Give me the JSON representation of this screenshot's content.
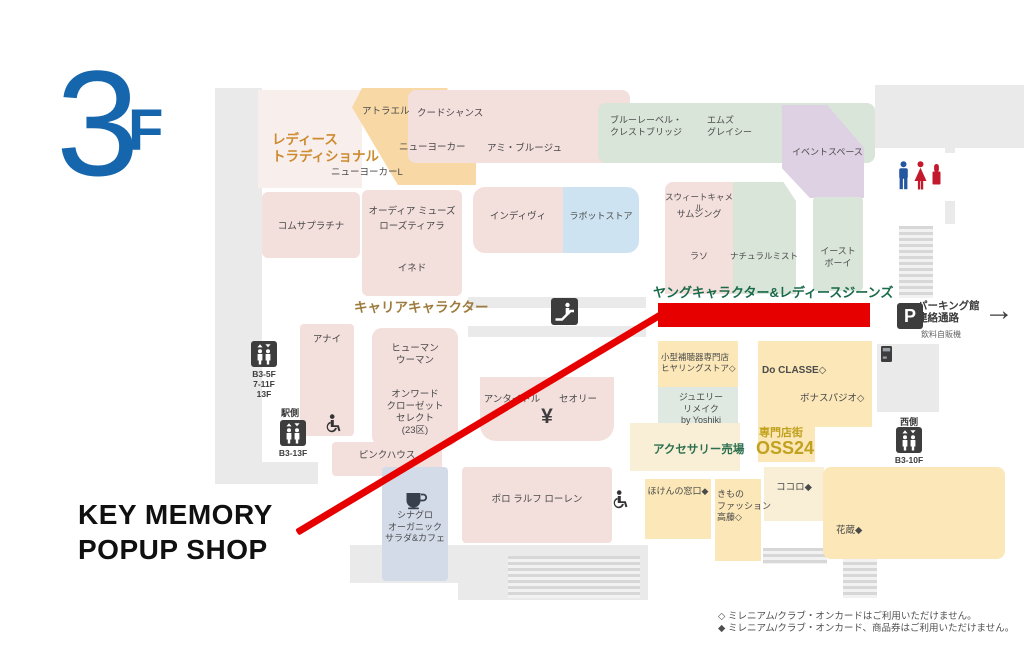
{
  "floor_label": {
    "number": "3",
    "suffix": "F"
  },
  "popup_annotation": {
    "line1": "KEY MEMORY",
    "line2": "POPUP SHOP"
  },
  "highlight": {
    "color": "#e60000",
    "target_label": "ヤングキャラクター&レディースジーンズ"
  },
  "notes": {
    "line1": "◇ ミレニアム/クラブ・オンカードはご利用いただけません。",
    "line2": "◆ ミレニアム/クラブ・オンカード、商品券はご利用いただけません。"
  },
  "colors": {
    "pink": "#f3dfdc",
    "palepink": "#f8efec",
    "orange": "#f8d9a6",
    "green": "#d9e5d9",
    "purple": "#ddd1e3",
    "blue": "#cde3f1",
    "bluegray": "#d3dbe9",
    "yellow": "#fbe7b7",
    "cream": "#f9efd7",
    "jewelry": "#dfe9e1",
    "white": "#ffffff",
    "accentBlue": "#1566ad",
    "red": "#e60000",
    "grayStruct": "#eaeaea"
  },
  "map": {
    "structures": [
      {
        "id": "left-corridor",
        "x": 215,
        "y": 88,
        "w": 47,
        "h": 376
      },
      {
        "id": "left-bottom-band",
        "x": 215,
        "y": 462,
        "w": 103,
        "h": 22
      },
      {
        "id": "top-right-corridor",
        "x": 875,
        "y": 85,
        "w": 149,
        "h": 63
      },
      {
        "id": "right-thin-strip",
        "x": 945,
        "y": 148,
        "w": 10,
        "h": 76
      },
      {
        "id": "right-mid-block",
        "x": 877,
        "y": 344,
        "w": 62,
        "h": 68
      },
      {
        "id": "center-corridor-bar-1",
        "x": 468,
        "y": 297,
        "w": 178,
        "h": 11
      },
      {
        "id": "center-corridor-bar-2",
        "x": 468,
        "y": 326,
        "w": 178,
        "h": 11
      },
      {
        "id": "bottom-corridor",
        "x": 458,
        "y": 545,
        "w": 190,
        "h": 55
      },
      {
        "id": "bottom-left-band",
        "x": 350,
        "y": 545,
        "w": 108,
        "h": 38
      }
    ],
    "stairs": [
      {
        "id": "parking-stairs",
        "x": 899,
        "y": 226,
        "w": 34,
        "h": 72
      },
      {
        "id": "bottom-center-stairs",
        "x": 508,
        "y": 556,
        "w": 132,
        "h": 42
      },
      {
        "id": "bottom-right-stairs",
        "x": 843,
        "y": 550,
        "w": 34,
        "h": 48
      },
      {
        "id": "small-stairs",
        "x": 763,
        "y": 548,
        "w": 64,
        "h": 16
      }
    ],
    "regions": [
      {
        "id": "ladies-traditional-area",
        "x": 258,
        "y": 90,
        "w": 104,
        "h": 98,
        "c": "palepink"
      },
      {
        "id": "atrael-new-yorker-block",
        "x": 352,
        "y": 88,
        "w": 124,
        "h": 97,
        "c": "orange",
        "clip": "polygon(8% 0%, 77% 0%, 77% 26%, 100% 50%, 100% 100%, 37% 100%, 0% 20%)"
      },
      {
        "id": "womens-top-block",
        "x": 408,
        "y": 90,
        "w": 222,
        "h": 73,
        "c": "pink",
        "r": 8
      },
      {
        "id": "green-top-block",
        "x": 598,
        "y": 103,
        "w": 277,
        "h": 60,
        "c": "green",
        "r": 8
      },
      {
        "id": "event-space-block",
        "x": 782,
        "y": 105,
        "w": 82,
        "h": 93,
        "c": "purple",
        "clip": "polygon(0% 0%, 55% 0%, 100% 46%, 100% 100%, 34% 100%, 0% 68%)"
      },
      {
        "id": "restroom-block",
        "x": 880,
        "y": 153,
        "w": 78,
        "h": 48,
        "c": "white"
      },
      {
        "id": "comme-ca-block",
        "x": 262,
        "y": 192,
        "w": 98,
        "h": 66,
        "c": "pink",
        "r": 6
      },
      {
        "id": "audia-block",
        "x": 362,
        "y": 190,
        "w": 100,
        "h": 106,
        "c": "pink",
        "r": 6
      },
      {
        "id": "indivi-block",
        "x": 473,
        "y": 187,
        "w": 90,
        "h": 66,
        "c": "pink",
        "r": "12px 0 0 12px"
      },
      {
        "id": "labot-block",
        "x": 563,
        "y": 187,
        "w": 76,
        "h": 66,
        "c": "blue",
        "r": "0 12px 12px 0"
      },
      {
        "id": "sweet-camel-block",
        "x": 665,
        "y": 182,
        "w": 68,
        "h": 112,
        "c": "pink",
        "r": "8px 0 0 0"
      },
      {
        "id": "natural-mist-block",
        "x": 733,
        "y": 182,
        "w": 63,
        "h": 112,
        "c": "green",
        "clip": "polygon(0% 0%, 80% 0%, 100% 17%, 100% 100%, 0% 100%)"
      },
      {
        "id": "east-boy-block",
        "x": 813,
        "y": 197,
        "w": 50,
        "h": 94,
        "c": "green",
        "r": 4
      },
      {
        "id": "anayi-block",
        "x": 300,
        "y": 324,
        "w": 54,
        "h": 112,
        "c": "pink",
        "r": 4
      },
      {
        "id": "human-woman-block",
        "x": 372,
        "y": 328,
        "w": 86,
        "h": 118,
        "c": "pink",
        "r": 10
      },
      {
        "id": "untitled-theory-block",
        "x": 480,
        "y": 377,
        "w": 134,
        "h": 64,
        "c": "pink",
        "r": "0 0 16px 16px"
      },
      {
        "id": "pink-house-block",
        "x": 332,
        "y": 442,
        "w": 110,
        "h": 34,
        "c": "pink",
        "r": 4
      },
      {
        "id": "polo-block",
        "x": 462,
        "y": 467,
        "w": 150,
        "h": 76,
        "c": "pink",
        "r": 4
      },
      {
        "id": "cinagro-block",
        "x": 382,
        "y": 467,
        "w": 66,
        "h": 114,
        "c": "bluegray",
        "r": 4
      },
      {
        "id": "hearing-store-block",
        "x": 658,
        "y": 341,
        "w": 80,
        "h": 46,
        "c": "yellow"
      },
      {
        "id": "jewelry-block",
        "x": 658,
        "y": 387,
        "w": 80,
        "h": 84,
        "c": "jewelry"
      },
      {
        "id": "do-classe-block",
        "x": 758,
        "y": 341,
        "w": 114,
        "h": 121,
        "c": "yellow",
        "clip": "polygon(0% 0%, 100% 0%, 100% 71%, 50% 71%, 50% 100%, 0% 100%)"
      },
      {
        "id": "accessory-area",
        "x": 630,
        "y": 423,
        "w": 110,
        "h": 48,
        "c": "cream"
      },
      {
        "id": "hoken-block",
        "x": 645,
        "y": 479,
        "w": 66,
        "h": 60,
        "c": "yellow"
      },
      {
        "id": "kimono-block",
        "x": 715,
        "y": 479,
        "w": 46,
        "h": 82,
        "c": "yellow"
      },
      {
        "id": "kokoro-area",
        "x": 764,
        "y": 467,
        "w": 60,
        "h": 54,
        "c": "cream"
      },
      {
        "id": "hanakura-block",
        "x": 823,
        "y": 467,
        "w": 182,
        "h": 92,
        "c": "yellow",
        "r": 8
      }
    ],
    "labels": [
      {
        "id": "ladies-traditional-label",
        "t": "レディース\nトラディショナル",
        "x": 272,
        "y": 132,
        "s": 13.5,
        "c": "#cd8a2f",
        "b": 1,
        "lh": 1.25
      },
      {
        "id": "atrael",
        "t": "アトラエル",
        "x": 362,
        "y": 106
      },
      {
        "id": "new-yorker",
        "t": "ニューヨーカー",
        "x": 399,
        "y": 142
      },
      {
        "id": "new-yorker-l",
        "t": "ニューヨーカーL",
        "x": 331,
        "y": 167
      },
      {
        "id": "coud-chance",
        "t": "クードシャンス",
        "x": 417,
        "y": 108
      },
      {
        "id": "ami-brooge",
        "t": "アミ・ブルージュ",
        "x": 487,
        "y": 143
      },
      {
        "id": "blue-label-crestbridge",
        "t": "ブルーレーベル・\nクレストブリッジ",
        "x": 610,
        "y": 115,
        "s": 9
      },
      {
        "id": "ms-gracy",
        "t": "エムズ\nグレイシー",
        "x": 707,
        "y": 115,
        "s": 9
      },
      {
        "id": "event-space",
        "t": "イベントスペース",
        "x": 792,
        "y": 147,
        "s": 9
      },
      {
        "id": "comme-ca-platinum",
        "t": "コムサプラチナ",
        "x": 262,
        "y": 221,
        "w": 98,
        "a": "c"
      },
      {
        "id": "odia-muse",
        "t": "オーディア ミューズ",
        "x": 362,
        "y": 206,
        "w": 100,
        "a": "c"
      },
      {
        "id": "rose-tiara",
        "t": "ローズティアラ",
        "x": 362,
        "y": 221,
        "w": 100,
        "a": "c"
      },
      {
        "id": "ined",
        "t": "イネド",
        "x": 362,
        "y": 263,
        "w": 100,
        "a": "c"
      },
      {
        "id": "indivi",
        "t": "インディヴィ",
        "x": 473,
        "y": 211,
        "w": 90,
        "a": "c"
      },
      {
        "id": "labot-store",
        "t": "ラボットストア",
        "x": 563,
        "y": 211,
        "w": 76,
        "a": "c",
        "s": 9
      },
      {
        "id": "sweet-camel",
        "t": "スウィートキャメル",
        "x": 661,
        "y": 192,
        "w": 76,
        "a": "c",
        "s": 8.5
      },
      {
        "id": "something",
        "t": "サムシング",
        "x": 663,
        "y": 209,
        "w": 72,
        "a": "c",
        "s": 9
      },
      {
        "id": "laso",
        "t": "ラソ",
        "x": 663,
        "y": 251,
        "w": 72,
        "a": "c",
        "s": 9
      },
      {
        "id": "natural-mist",
        "t": "ナチュラルミスト",
        "x": 730,
        "y": 251,
        "w": 68,
        "a": "c",
        "s": 8.5
      },
      {
        "id": "east-boy",
        "t": "イースト\nボーイ",
        "x": 813,
        "y": 246,
        "w": 50,
        "a": "c",
        "s": 9
      },
      {
        "id": "career-character-label",
        "t": "キャリアキャラクター",
        "x": 354,
        "y": 299,
        "s": 13.5,
        "c": "#9d7b3e",
        "b": 1
      },
      {
        "id": "young-character-ladies-jeans-label",
        "t": "ヤングキャラクター&レディースジーンズ",
        "x": 653,
        "y": 285,
        "s": 13,
        "c": "#186a49",
        "b": 1
      },
      {
        "id": "anayi",
        "t": "アナイ",
        "x": 300,
        "y": 334,
        "w": 54,
        "a": "c"
      },
      {
        "id": "human-woman",
        "t": "ヒューマン\nウーマン",
        "x": 372,
        "y": 343,
        "w": 86,
        "a": "c"
      },
      {
        "id": "onward-closet-select",
        "t": "オンワード\nクローゼット\nセレクト\n(23区)",
        "x": 372,
        "y": 389,
        "w": 86,
        "a": "c",
        "lh": 1.28
      },
      {
        "id": "untitled",
        "t": "アンタイトル",
        "x": 478,
        "y": 394,
        "w": 68,
        "a": "c"
      },
      {
        "id": "theory",
        "t": "セオリー",
        "x": 548,
        "y": 394,
        "w": 60,
        "a": "c"
      },
      {
        "id": "yen-atm-label",
        "t": "¥",
        "x": 480,
        "y": 403,
        "w": 134,
        "a": "c",
        "s": 21,
        "c": "#3d3d3d",
        "b": 1
      },
      {
        "id": "pink-house",
        "t": "ピンクハウス",
        "x": 332,
        "y": 450,
        "w": 110,
        "a": "c"
      },
      {
        "id": "polo-ralph-lauren",
        "t": "ポロ ラルフ ローレン",
        "x": 462,
        "y": 494,
        "w": 150,
        "a": "c"
      },
      {
        "id": "cinagro-organic-salad-cafe",
        "t": "シナグロ\nオーガニック\nサラダ&カフェ",
        "x": 382,
        "y": 510,
        "w": 66,
        "a": "c",
        "s": 9
      },
      {
        "id": "hearing-store",
        "t": "小型補聴器専門店\nヒヤリングストア◇",
        "x": 661,
        "y": 352,
        "s": 8.5
      },
      {
        "id": "jewelry-remake",
        "t": "ジュエリー\nリメイク\nby Yoshiki",
        "x": 668,
        "y": 392,
        "w": 66,
        "a": "c",
        "s": 9
      },
      {
        "id": "do-classe",
        "t": "Do CLASSE◇",
        "x": 762,
        "y": 364,
        "s": 10,
        "b": 1
      },
      {
        "id": "bonas-pajio",
        "t": "ボナスパジオ◇",
        "x": 800,
        "y": 393
      },
      {
        "id": "senmontengai-label",
        "t": "専門店街",
        "x": 759,
        "y": 426,
        "s": 11,
        "c": "#c2a11f",
        "b": 1
      },
      {
        "id": "oss24-label",
        "t": "OSS24",
        "x": 756,
        "y": 437,
        "s": 18,
        "c": "#c2a11f",
        "b": 1
      },
      {
        "id": "accessory-area-label",
        "t": "アクセサリー売場",
        "x": 653,
        "y": 443,
        "s": 11.5,
        "c": "#2b6f4f",
        "b": 1
      },
      {
        "id": "hoken-no-madoguchi",
        "t": "ほけんの窓口◆",
        "x": 645,
        "y": 486,
        "w": 66,
        "a": "c",
        "s": 9
      },
      {
        "id": "kimono-fashion-takato",
        "t": "きもの\nファッション\n高藤◇",
        "x": 717,
        "y": 489,
        "s": 9
      },
      {
        "id": "kokoro",
        "t": "ココロ◆",
        "x": 764,
        "y": 482,
        "w": 60,
        "a": "c"
      },
      {
        "id": "hanakura",
        "t": "花蔵◆",
        "x": 836,
        "y": 525
      },
      {
        "id": "parking-connection-label",
        "t": "パーキング館\n連絡通路",
        "x": 917,
        "y": 300,
        "s": 10.5,
        "c": "#3c3c3c",
        "b": 1,
        "lh": 1.15
      },
      {
        "id": "drink-vending-label",
        "t": "飲料自販機",
        "x": 921,
        "y": 330,
        "s": 8,
        "c": "#666666"
      },
      {
        "id": "station-side-label",
        "t": "駅側",
        "x": 281,
        "y": 408,
        "s": 9,
        "c": "#3c3c3c",
        "b": 1
      },
      {
        "id": "elevator-b3-13f-label",
        "t": "B3-13F",
        "x": 271,
        "y": 448,
        "w": 44,
        "a": "c",
        "s": 8.5,
        "c": "#3c3c3c",
        "b": 1
      },
      {
        "id": "elevator-b3-5f-label",
        "t": "B3-5F\n7-11F\n13F",
        "x": 243,
        "y": 369,
        "w": 42,
        "a": "c",
        "s": 8.5,
        "c": "#3c3c3c",
        "b": 1,
        "lh": 1.2
      },
      {
        "id": "west-side-label",
        "t": "西側",
        "x": 891,
        "y": 417,
        "w": 36,
        "a": "c",
        "s": 9,
        "c": "#3c3c3c",
        "b": 1
      },
      {
        "id": "elevator-b3-10f-label",
        "t": "B3-10F",
        "x": 888,
        "y": 455,
        "w": 42,
        "a": "c",
        "s": 8.5,
        "c": "#3c3c3c",
        "b": 1
      }
    ],
    "facilities": [
      {
        "type": "escalator-icon",
        "x": 551,
        "y": 298
      },
      {
        "type": "elevator-icon",
        "x": 251,
        "y": 341
      },
      {
        "type": "elevator-icon",
        "x": 280,
        "y": 420
      },
      {
        "type": "elevator-icon",
        "x": 896,
        "y": 427
      },
      {
        "type": "wheelchair-icon",
        "x": 325,
        "y": 414
      },
      {
        "type": "wheelchair-icon",
        "x": 612,
        "y": 490
      },
      {
        "type": "restroom-men-icon",
        "x": 897,
        "y": 161
      },
      {
        "type": "restroom-women-icon",
        "x": 913,
        "y": 161
      },
      {
        "type": "cosmetics-icon",
        "x": 931,
        "y": 162
      },
      {
        "type": "parking-icon",
        "x": 897,
        "y": 303
      },
      {
        "type": "arrow-right-icon",
        "x": 984,
        "y": 296
      },
      {
        "type": "vending-machine-icon",
        "x": 881,
        "y": 346
      },
      {
        "type": "cafe-icon",
        "x": 404,
        "y": 491
      }
    ]
  }
}
